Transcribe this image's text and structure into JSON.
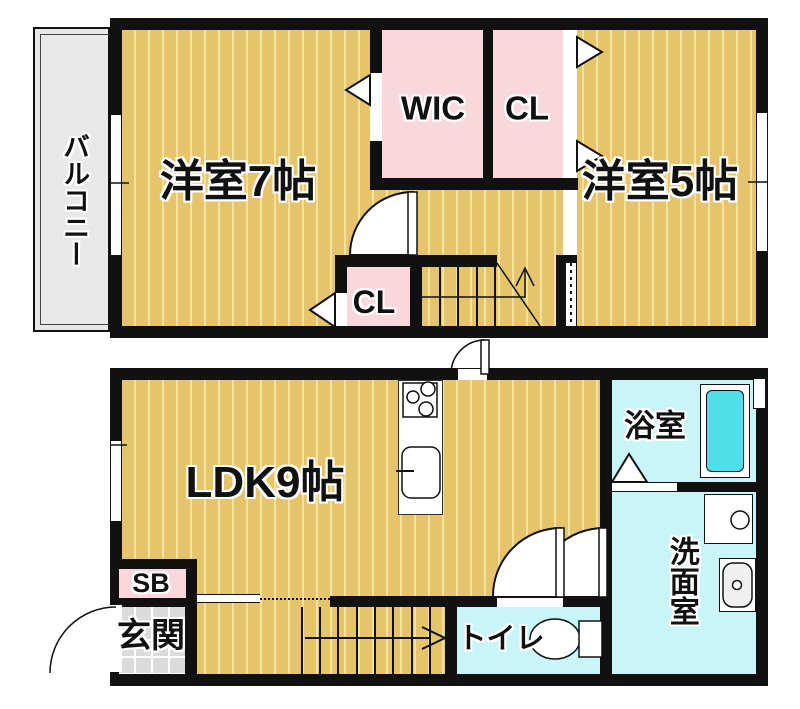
{
  "upper_floor": {
    "balcony_label": "バルコニー",
    "room7_label": "洋室7帖",
    "wic_label": "WIC",
    "cl_label": "CL",
    "room5_label": "洋室5帖",
    "cl2_label": "CL"
  },
  "lower_floor": {
    "ldk_label": "LDK9帖",
    "sb_label": "SB",
    "entrance_label": "玄関",
    "toilet_label": "トイレ",
    "bath_label": "浴室",
    "washroom_label": "洗面室"
  },
  "colors": {
    "wall": "#111111",
    "floor_tan": "#E6C46C",
    "floor_stripe": "#F3E1A0",
    "closet_pink": "#F9D8DD",
    "wet_cyan": "#C9F4F8",
    "bathtub_cyan": "#4EDFE8",
    "balcony_grey": "#E8E8E8",
    "entrance_tile_grey": "#DBDBDB"
  }
}
